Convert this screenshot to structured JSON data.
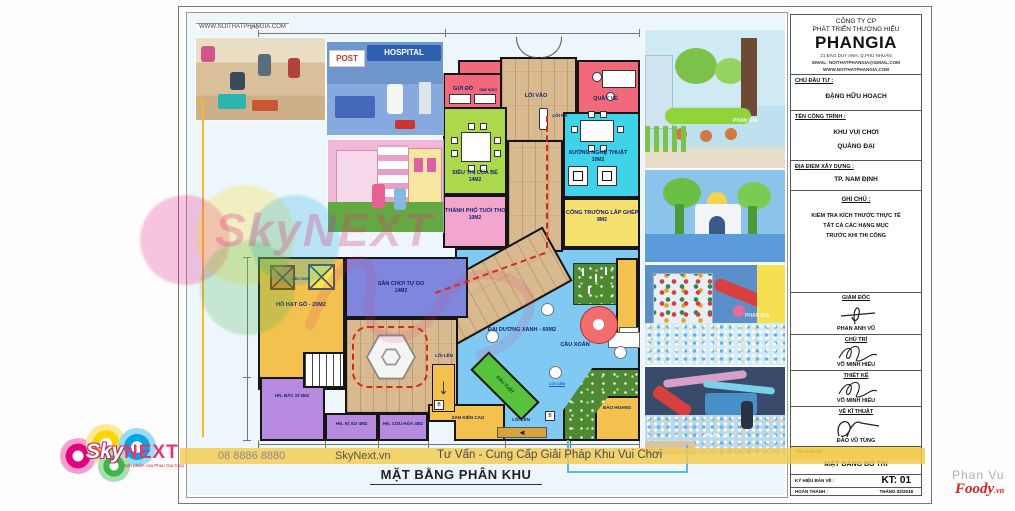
{
  "frame": {
    "website": "WWW.NOITHATPHANGIA.COM"
  },
  "title_block": {
    "company": {
      "line1": "CÔNG TY CP",
      "line2": "PHÁT TRIỂN THƯƠNG HIỆU",
      "name": "PHANGIA",
      "address": "21 ĐÀO DUY ANH, Q.PHÚ NHUẬN",
      "email": "EMAIL: NOITHATPHANGIA@GMAIL.COM",
      "website": "WWW.NOITHATPHANGIA.COM"
    },
    "investor": {
      "label": "CHỦ ĐẦU TƯ :",
      "value": "ĐẶNG HỮU HOẠCH"
    },
    "project": {
      "label": "TÊN CÔNG TRÌNH :",
      "line1": "KHU VUI CHƠI",
      "line2": "QUẢNG ĐẠI"
    },
    "location": {
      "label": "ĐỊA ĐIỂM XÂY DỰNG :",
      "value": "TP. NAM ĐỊNH"
    },
    "note": {
      "label": "GHI CHÚ :",
      "line1": "KIỂM TRA KÍCH THƯỚC THỰC TẾ",
      "line2": "TẤT CẢ CÁC HẠNG MỤC",
      "line3": "TRƯỚC KHI THI CÔNG"
    },
    "signatures": [
      {
        "role": "GIÁM ĐỐC",
        "name": "PHAN ANH VŨ"
      },
      {
        "role": "CHỦ TRÌ",
        "name": "VÕ MINH HIẾU"
      },
      {
        "role": "THIẾT KẾ",
        "name": "VÕ MINH HIẾU"
      },
      {
        "role": "VẼ KĨ THUẬT",
        "name": "ĐÀO VŨ TÙNG"
      }
    ],
    "drawing_name": {
      "label": "TÊN BẢN VẼ :",
      "value": "MẶT BẰNG BỐ TRÍ"
    },
    "drawing_code": {
      "label": "KÝ HIỆU BẢN VẼ :",
      "value": "KT: 01"
    },
    "completed": {
      "label": "HOÀN THÀNH :",
      "value": "THÁNG 02/2018"
    }
  },
  "plan": {
    "rooms": [
      {
        "label": "GỬI ĐỒ",
        "sub": "GHẾ NGỒI"
      },
      {
        "label": "QUẦY VÉ"
      },
      {
        "label": "LỐI VÀO"
      },
      {
        "label": "LỐI RA"
      },
      {
        "label": "SIÊU THỊ CỦA BÉ",
        "area": "14M2"
      },
      {
        "label": "XƯỞNG NGHỆ THUẬT",
        "area": "10M2"
      },
      {
        "label": "THÀNH PHỐ TUỔI THƠ",
        "area": "10M2"
      },
      {
        "label": "CÔNG TRƯỜNG LẮP GHÉP",
        "area": "8M2"
      },
      {
        "label": "HỒ HẠT GỖ - 20M2",
        "sub": "LỀU CHƠI"
      },
      {
        "label": "SÂN CHƠI TỰ DO",
        "area": "14M2"
      },
      {
        "label": "HN. BÁC SĨ 5M2"
      },
      {
        "label": "HN. KỈ SƯ 4M2"
      },
      {
        "label": "HN. CỨU HỎA 4M2"
      },
      {
        "label": "ĐẠI DƯƠNG XANH - 60M2"
      },
      {
        "label": "CẦU XOẮN"
      },
      {
        "label": "CẦU TUỘT"
      },
      {
        "label": "SÀN KIẾN CAO"
      },
      {
        "label": "ĐẢO HOANG"
      },
      {
        "label": "LỐI LÊN"
      },
      {
        "label": "LỐI LÊN"
      },
      {
        "label": "LỐI LÊN"
      }
    ],
    "dimensions": {
      "top": "270"
    }
  },
  "photos": {
    "post_sign": "POST",
    "hospital_sign": "HOSPITAL",
    "watermark": "PHAN GIA"
  },
  "footer": {
    "phone": "08 8886 8880",
    "website": "SkyNext.vn",
    "tagline": "Tư Vấn - Cung Cấp Giải Pháp Khu Vui Chơi",
    "sheet_title": "MẶT BẰNG PHÂN KHU"
  },
  "logo": {
    "sky": "Sky",
    "next": "NEXT",
    "tagline": "Sản phẩm của Phan Gia Corp"
  },
  "watermarks": {
    "center": "SkyNEXT",
    "credit_name": "Phan Vu",
    "credit_site": "Foody",
    "credit_suffix": ".vn"
  },
  "colors": {
    "accent_gold": "#f2c14e",
    "wall": "#141414",
    "ocean_blue": "#7fc9f2",
    "wood": "#d9ba90"
  }
}
